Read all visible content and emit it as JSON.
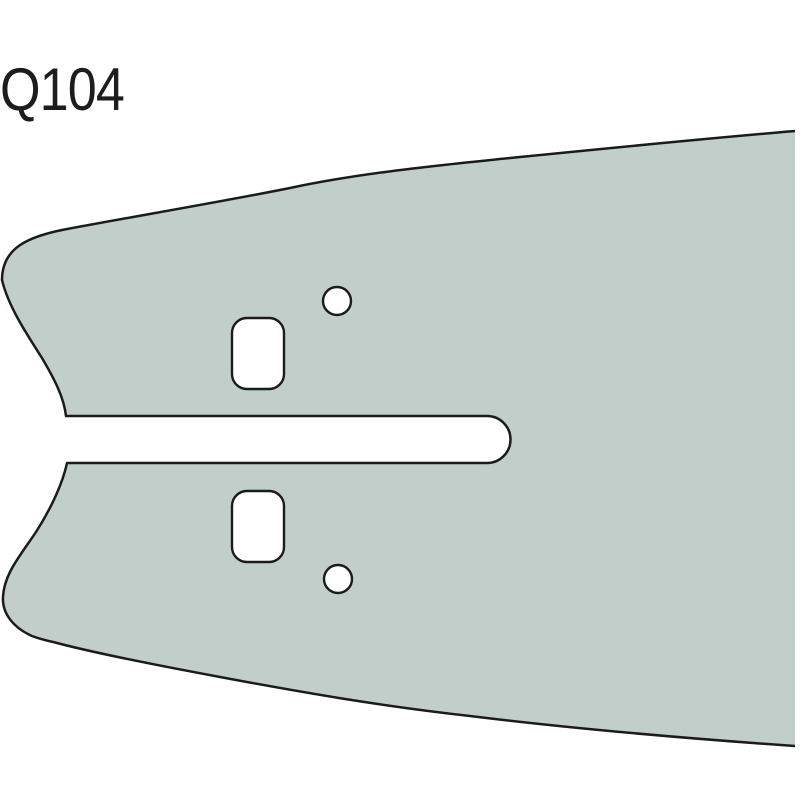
{
  "diagram": {
    "part_code": "Q104",
    "part_code_font_px": 60,
    "colors": {
      "background": "#ffffff",
      "bar_fill": "#c2cec9",
      "outline": "#1a1c1b",
      "hole_fill": "#ffffff",
      "label_text": "#1d1d1b"
    },
    "features": {
      "bar_body": "guide-bar-tail",
      "mount_slot": "mount-slot-open-left",
      "upper_adjustment_hole": "rounded-rect-hole",
      "lower_adjustment_hole": "rounded-rect-hole",
      "upper_oiler_hole": "round-hole",
      "lower_oiler_hole": "round-hole"
    }
  }
}
